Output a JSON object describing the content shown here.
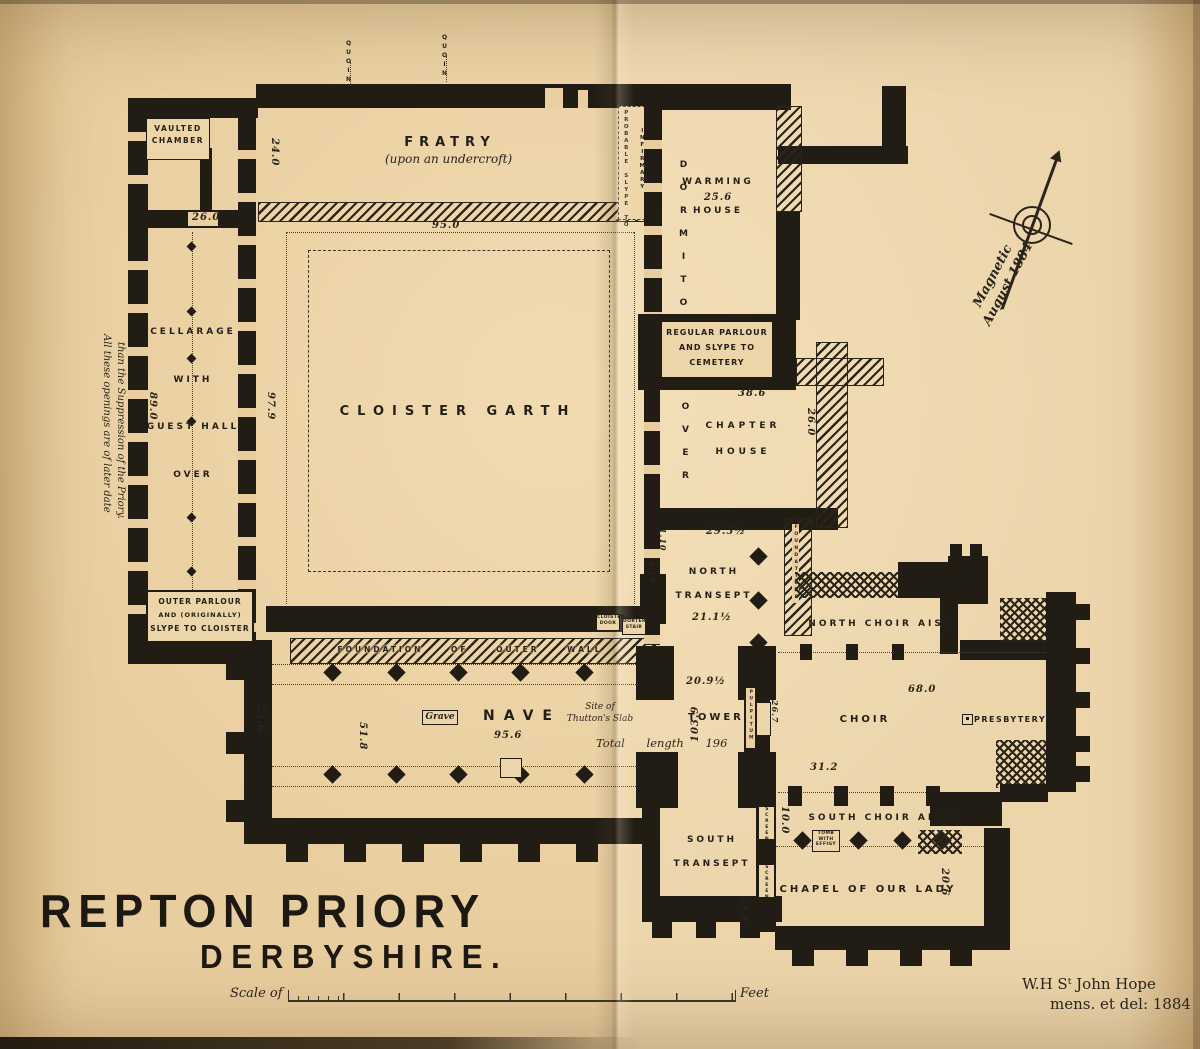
{
  "title": {
    "main": "REPTON PRIORY",
    "sub": "DERBYSHIRE."
  },
  "scale": {
    "prefix": "Scale of",
    "suffix": "Feet"
  },
  "attribution": {
    "line1": "W.H Sᵗ John Hope",
    "line2": "mens. et del: 1884"
  },
  "compass": {
    "line1": "Magnetic",
    "line2": "August 1884"
  },
  "margin_note": {
    "line1": "All these openings are of later date",
    "line2": "than the Suppression of the Priory."
  },
  "quoin": "QUOIN",
  "rooms": {
    "vaulted1": "VAULTED",
    "vaulted2": "CHAMBER",
    "fratry": "FRATRY",
    "fratry_sub": "(upon an undercroft)",
    "cellarage1": "CELLARAGE",
    "cellarage2": "WITH",
    "cellarage3": "GUEST HALL",
    "cellarage4": "OVER",
    "outer1": "OUTER PARLOUR",
    "outer2": "AND (ORIGINALLY)",
    "outer3": "SLYPE TO CLOISTER",
    "cloister": "CLOISTER GARTH",
    "warming1": "WARMING",
    "warming2": "HOUSE",
    "dormitory": "DORMITORY",
    "dormitory_over": "OVER",
    "slype1": "PROBABLE SLYPE TO",
    "slype2": "INFIRMARY",
    "regular1": "REGULAR PARLOUR",
    "regular2": "AND SLYPE TO",
    "regular3": "CEMETERY",
    "chapter1": "CHAPTER",
    "chapter2": "HOUSE",
    "ntransept1": "NORTH",
    "ntransept2": "TRANSEPT",
    "nchoiraisle": "NORTH CHOIR AISLE",
    "foundation": "FOUNDATION OF OUTER WALL",
    "nave": "NAVE",
    "grave": "Grave",
    "site1": "Site of",
    "site2": "Thutton's Slab",
    "total": "Total length 196",
    "tower": "TOWER",
    "choir": "CHOIR",
    "presbytery": "PRESBYTERY",
    "schoiraisle": "SOUTH CHOIR AISLE",
    "stransept1": "SOUTH",
    "stransept2": "TRANSEPT",
    "chapel": "CHAPEL OF OUR LADY"
  },
  "tiny": {
    "pulpitum": "PULPITUM",
    "screen": "SCREEN",
    "tomb": "TOMB WITH EFFIGY",
    "cloister_door": "CLOISTER DOOR",
    "dorter_stair": "DORTER STAIR",
    "strip": "FOUNDATIONS"
  },
  "dims": {
    "w24": "24.0",
    "w26": "26.0",
    "f95": "95.0",
    "c89": "89.0",
    "c97": "97.9",
    "wh25": "25.6",
    "ch38": "38.6",
    "ch26": "26.0",
    "nt29": "29.5½",
    "nt21": "21.1½",
    "nt110": "1.10",
    "nt410": "4.10",
    "nv209": "20.9½",
    "tw103": "103.9",
    "tw26": "26.7",
    "co68": "68.0",
    "co31": "31.2",
    "nv95": "95.6",
    "nv23": "23.6",
    "nv51": "51.8",
    "sa10": "10.0",
    "sc21": "21.9",
    "cl20": "20.6"
  }
}
